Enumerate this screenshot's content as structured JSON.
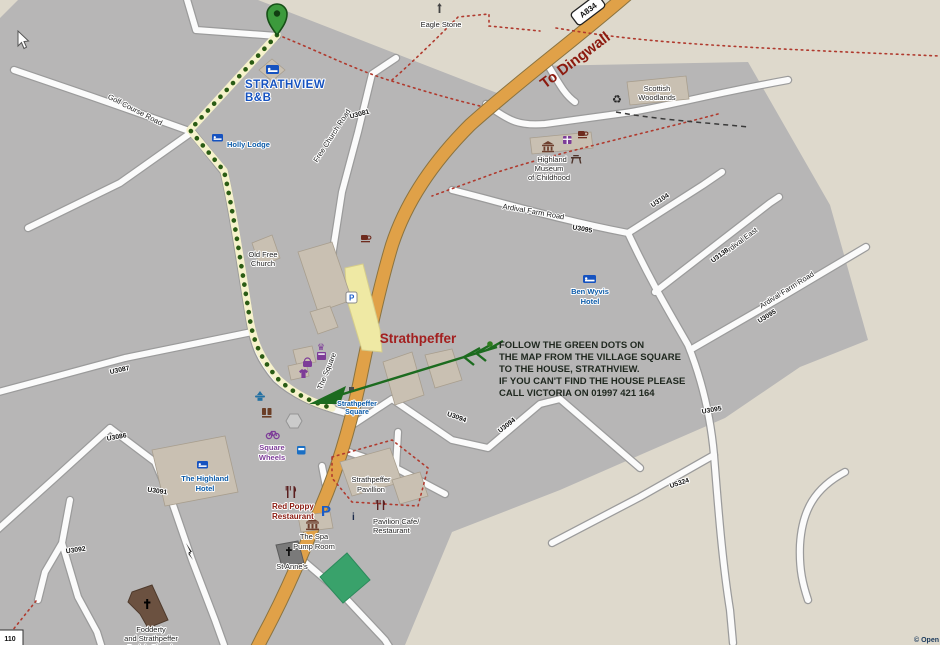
{
  "map": {
    "signs": {
      "a834": "A834",
      "to_dingwall": "To Dingwall",
      "marker_110": "110"
    },
    "road_refs": {
      "u3081": "U3081",
      "u3086": "U3086",
      "u3087": "U3087",
      "u3091": "U3091",
      "u3092": "U3092",
      "u3094": "U3094",
      "u3095": "U3095",
      "u3104": "U3104",
      "u3138": "U3138",
      "u5324": "U5324"
    },
    "street_names": {
      "golf_course_road": "Golf Course Road",
      "free_church_road": "Free Church Road",
      "the_square": "The Square",
      "ardival_farm_road": "Ardival Farm Road",
      "ardival_east": "Ardival East"
    },
    "places": {
      "eagle_stone": "Eagle Stone",
      "strathview_1": "STRATHVIEW",
      "strathview_2": "B&B",
      "holly_lodge": "Holly Lodge",
      "scottish_woodlands_1": "Scottish",
      "scottish_woodlands_2": "Woodlands",
      "museum_1": "Highland",
      "museum_2": "Museum",
      "museum_3": "of Childhood",
      "ben_wyvis_1": "Ben Wyvis",
      "ben_wyvis_2": "Hotel",
      "old_free_church_1": "Old Free",
      "old_free_church_2": "Church",
      "strathpeffer_title": "Strathpeffer",
      "strathpeffer_square_1": "Strathpeffer",
      "strathpeffer_square_2": "Square",
      "square_wheels_1": "Square",
      "square_wheels_2": "Wheels",
      "highland_hotel_1": "The Highland",
      "highland_hotel_2": "Hotel",
      "red_poppy_1": "Red Poppy",
      "red_poppy_2": "Restaurant",
      "pavillion_1": "Strathpeffer",
      "pavillion_2": "Pavillion",
      "pavilion_cafe_1": "Pavilion Cafe/",
      "pavilion_cafe_2": "Restaurant",
      "spa_pump_1": "The Spa",
      "spa_pump_2": "Pump Room",
      "st_annes": "St Anne's",
      "fodderty_1": "Fodderty",
      "fodderty_2": "and Strathpeffer",
      "fodderty_3": "Parish Church"
    },
    "annotation": {
      "line1": "FOLLOW THE GREEN DOTS ON",
      "line2": "THE MAP FROM THE VILLAGE SQUARE",
      "line3": "TO THE HOUSE, STRATHVIEW.",
      "line4": "IF YOU CAN'T FIND THE HOUSE PLEASE",
      "line5": "CALL VICTORIA ON 01997 421 164"
    },
    "icon_glyphs": {
      "parking": "P",
      "info": "i",
      "recycle": "♻",
      "crown": "♛"
    },
    "copyright": "© Open",
    "colors": {
      "route_green": "#2a5c14",
      "arrow_green": "#1c6b1f",
      "pin_green": "#3c9a3c",
      "road_orange": "#e0a148",
      "map_gray": "#b7b6b6",
      "background_beige": "#ded9cc",
      "poi_blue": "#0a5aa8",
      "shop_purple": "#7d3c98",
      "title_red": "#a31f1f"
    }
  }
}
